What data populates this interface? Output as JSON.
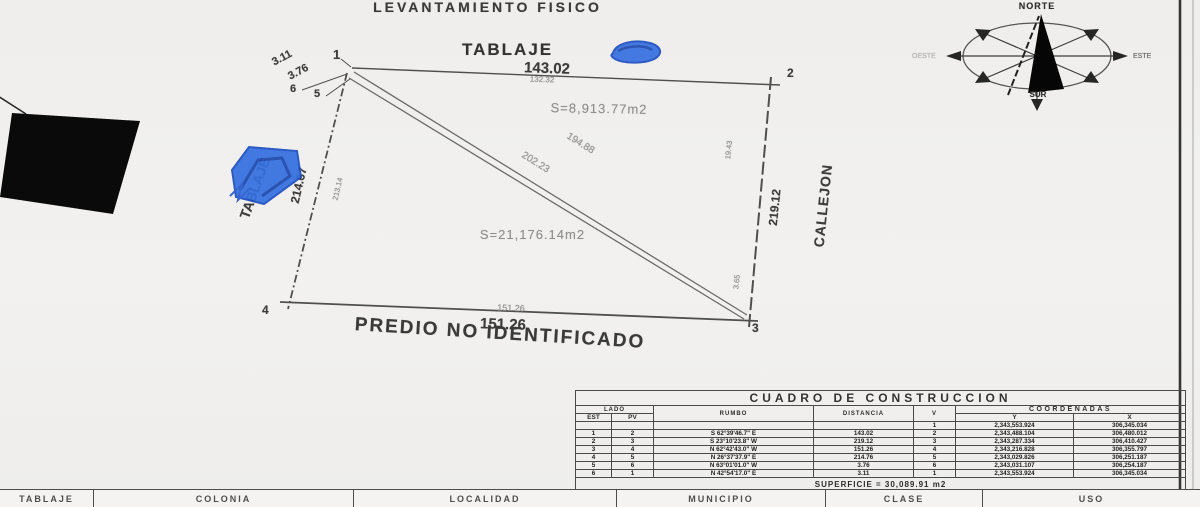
{
  "document": {
    "title": "LEVANTAMIENTO FISICO"
  },
  "plot": {
    "heading": "TABLAJE",
    "handwriting_label": "TABLAJE",
    "street_label": "CALLEJON",
    "adjacent_label": "PREDIO NO IDENTIFICADO",
    "vertices": [
      "1",
      "2",
      "3",
      "4",
      "5",
      "6"
    ],
    "edges": {
      "top": "143.02",
      "top_sub": "132.32",
      "right": "219.12",
      "bottom_sub": "151.26",
      "bottom": "151.26",
      "left": "214.67",
      "left_sub": "213.14",
      "v6_v1": "3.11",
      "v5_v6": "3.76",
      "diag_upper": "194.88",
      "diag_lower": "202.23",
      "inner_right": "19.43",
      "inner_bottom": "3.65"
    },
    "areas": {
      "upper": "S=8,913.77m2",
      "lower": "S=21,176.14m2"
    }
  },
  "compass": {
    "north": "NORTE",
    "south": "SUR",
    "east": "ESTE",
    "west": "OESTE"
  },
  "construction_table": {
    "title": "CUADRO DE CONSTRUCCION",
    "headers": {
      "lado": "LADO",
      "est": "EST",
      "pv": "PV",
      "rumbo": "RUMBO",
      "distancia": "DISTANCIA",
      "v": "V",
      "coordenadas": "COORDENADAS",
      "y": "Y",
      "x": "X"
    },
    "rows": [
      {
        "est": "",
        "pv": "",
        "rumbo": "",
        "distancia": "",
        "v": "1",
        "y": "2,343,553.924",
        "x": "306,345.034"
      },
      {
        "est": "1",
        "pv": "2",
        "rumbo": "S 62°39'46.7\" E",
        "distancia": "143.02",
        "v": "2",
        "y": "2,343,488.104",
        "x": "306,480.012"
      },
      {
        "est": "2",
        "pv": "3",
        "rumbo": "S 23°10'23.8\" W",
        "distancia": "219.12",
        "v": "3",
        "y": "2,343,287.334",
        "x": "306,410.427"
      },
      {
        "est": "3",
        "pv": "4",
        "rumbo": "N 62°42'43.0\" W",
        "distancia": "151.26",
        "v": "4",
        "y": "2,343,216.828",
        "x": "306,355.797"
      },
      {
        "est": "4",
        "pv": "5",
        "rumbo": "N 26°37'37.9\" E",
        "distancia": "214.76",
        "v": "5",
        "y": "2,343,029.826",
        "x": "306,251.187"
      },
      {
        "est": "5",
        "pv": "6",
        "rumbo": "N 63°01'01.0\" W",
        "distancia": "3.76",
        "v": "6",
        "y": "2,343,031.107",
        "x": "306,254.187"
      },
      {
        "est": "6",
        "pv": "1",
        "rumbo": "N 42°54'17.0\" E",
        "distancia": "3.11",
        "v": "1",
        "y": "2,343,553.924",
        "x": "306,345.034"
      }
    ],
    "superficie": "SUPERFICIE = 30,089.91 m2"
  },
  "footer_bar": {
    "cells": [
      "TABLAJE",
      "COLONIA",
      "LOCALIDAD",
      "MUNICIPIO",
      "CLASE",
      "USO"
    ]
  }
}
